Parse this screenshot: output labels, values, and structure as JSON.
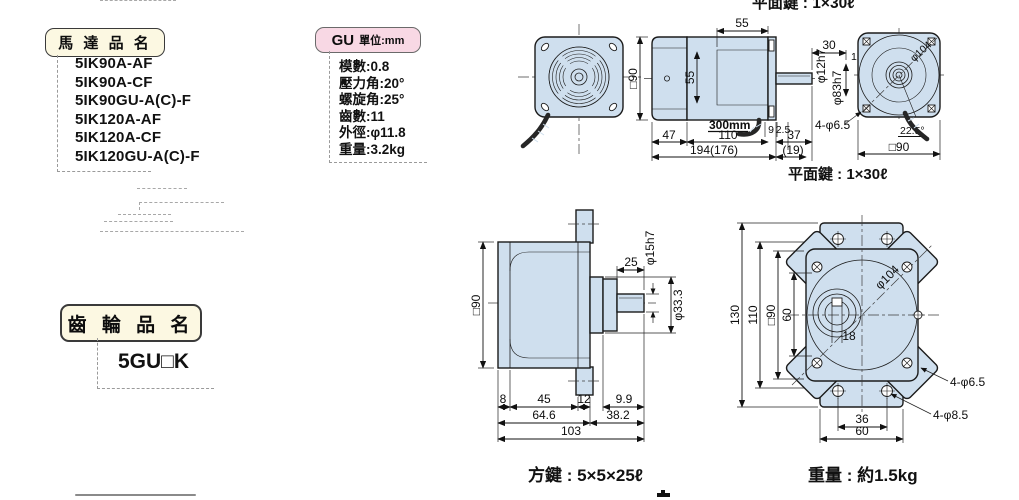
{
  "colors": {
    "drawing_fill": "#cfdfee",
    "panel_cream": "#fcf8e2",
    "panel_pink": "#f8d8e4"
  },
  "motor_panel": {
    "title": "馬 達 品 名",
    "models": [
      "5IK90A-AF",
      "5IK90A-CF",
      "5IK90GU-A(C)-F",
      "5IK120A-AF",
      "5IK120A-CF",
      "5IK120GU-A(C)-F"
    ]
  },
  "gu_panel": {
    "title": "GU",
    "unit": "單位:mm",
    "specs": [
      "模數:0.8",
      "壓力角:20°",
      "螺旋角:25°",
      "齒數:11",
      "外徑:φ11.8",
      "重量:3.2kg"
    ]
  },
  "gear_panel": {
    "title": "齒 輪 品 名",
    "model": "5GU□K"
  },
  "labels": {
    "key_top": "平面鍵 : 1×30ℓ",
    "key_bottom": "平面鍵 : 1×30ℓ",
    "square_key": "方鍵 : 5×5×25ℓ",
    "gear_weight": "重量 : 約1.5kg"
  },
  "motor_side": {
    "d55_top": "55",
    "sq90": "□90",
    "d55_in": "55",
    "d30": "30",
    "d1": "1",
    "shaft_dia": "φ12h7",
    "spigot_dia": "φ83h7",
    "lead": "300mm",
    "d9": "9",
    "d2_5": "2.5",
    "d37": "37",
    "d19": "(19)",
    "d47": "47",
    "d110": "110",
    "total": "194(176)"
  },
  "motor_rear": {
    "pitch_dia": "φ104",
    "holes": "4-φ6.5",
    "angle": "22.5°",
    "sq90": "□90"
  },
  "gear_side": {
    "sq90": "□90",
    "d25": "25",
    "shaft_dia": "φ15h7",
    "boss_dia": "φ33.3",
    "d8": "8",
    "d45": "45",
    "d12": "12",
    "d9_9": "9.9",
    "d64_6": "64.6",
    "d38_2": "38.2",
    "d103": "103"
  },
  "gear_front": {
    "d130": "130",
    "d110": "110",
    "sq90": "□90",
    "d60v": "60",
    "pitch_dia": "φ104",
    "d18": "18",
    "d36": "36",
    "d60h": "60",
    "holes_small": "4-φ6.5",
    "holes_large": "4-φ8.5"
  }
}
